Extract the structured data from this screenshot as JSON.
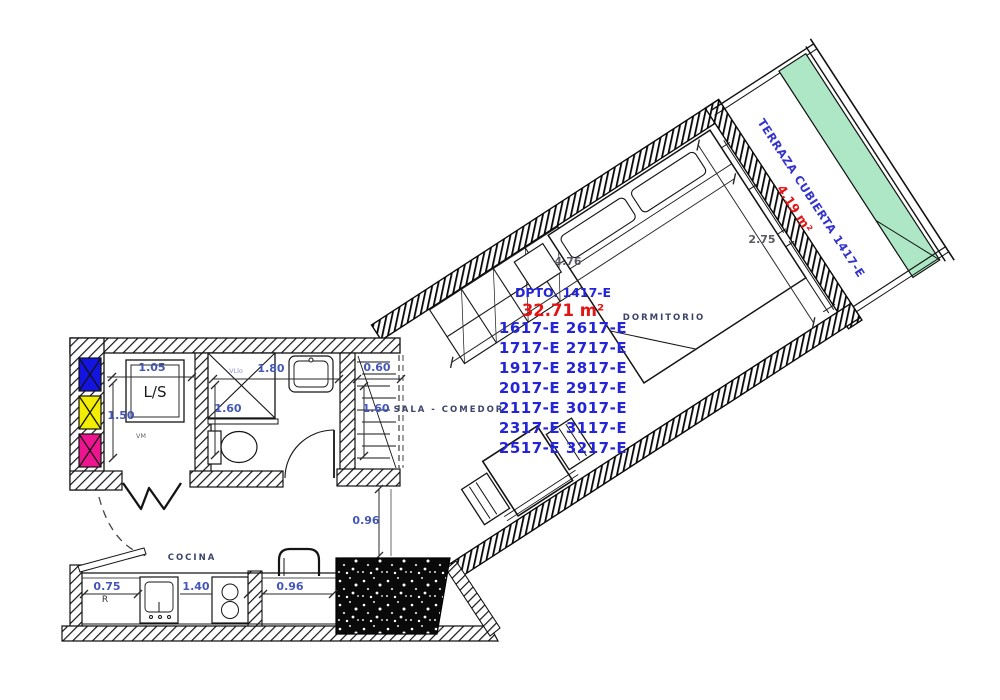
{
  "plan": {
    "title": "Apartment floor plan DPTO 1417-E"
  },
  "dpto": {
    "title": "DPTO. 1417-E",
    "area": "32.71 m²",
    "units": [
      "1617-E 2617-E",
      "1717-E 2717-E",
      "1917-E 2817-E",
      "2017-E 2917-E",
      "2117-E 3017-E",
      "2317-E 3117-E",
      "2517-E 3217-E"
    ]
  },
  "terraza": {
    "name": "TERRAZA CUBIERTA 1417-E",
    "area": "4.19 m²"
  },
  "labels": {
    "dormitorio": "DORMITORIO",
    "sala_comedor": "SALA - COMEDOR",
    "cocina": "COCINA",
    "ls": "L/S",
    "r": "R",
    "vm": "VM",
    "vllo": "VLlo"
  },
  "dims": {
    "ls_width": "1.05",
    "ls_depth": "1.50",
    "shower_width": "1.80",
    "bath_depth": "1.60",
    "closet_width": "0.60",
    "closet_depth": "1.60",
    "hall_width": "0.96",
    "closet_run": "4.76",
    "bedroom_depth": "2.75",
    "kitchen_left": "0.75",
    "kitchen_counter": "1.40",
    "kitchen_right": "0.96"
  },
  "colors": {
    "wall_ink": "#111118",
    "terrace_green": "#aee7c6",
    "meter_blue": "#1414e0",
    "meter_yellow": "#f3ee00",
    "meter_magenta": "#ee1490",
    "dim_blue": "#4456b8",
    "dim_gray": "#5a5a64",
    "unit_blue": "#2424d8",
    "area_red": "#e41414",
    "label_navy": "#3c4468",
    "terraza_blue": "#3434cc"
  }
}
